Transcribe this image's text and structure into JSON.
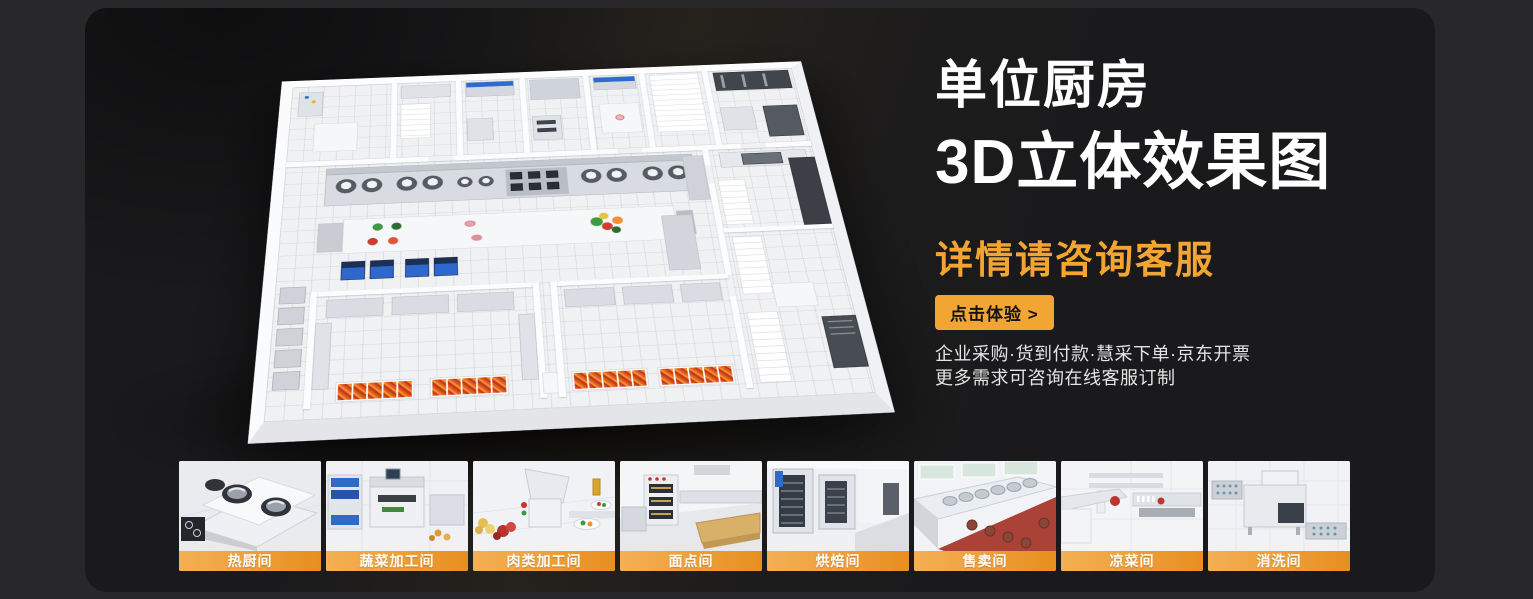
{
  "hero": {
    "title_line1": "单位厨房",
    "title_line2": "3D立体效果图",
    "subtitle": "详情请咨询客服",
    "cta_label": "点击体验 >",
    "note_line1": "企业采购·货到付款·慧采下单·京东开票",
    "note_line2": "更多需求可咨询在线客服订制"
  },
  "thumbnails": [
    {
      "label": "热厨间"
    },
    {
      "label": "蔬菜加工间"
    },
    {
      "label": "肉类加工间"
    },
    {
      "label": "面点间"
    },
    {
      "label": "烘焙间"
    },
    {
      "label": "售卖间"
    },
    {
      "label": "凉菜间"
    },
    {
      "label": "消洗间"
    }
  ],
  "colors": {
    "accent_orange": "#F2A533",
    "card_bg": "#1A1A1C",
    "page_bg": "#28282B",
    "label_gradient_start": "#F4B055",
    "label_gradient_end": "#E78F1F"
  }
}
